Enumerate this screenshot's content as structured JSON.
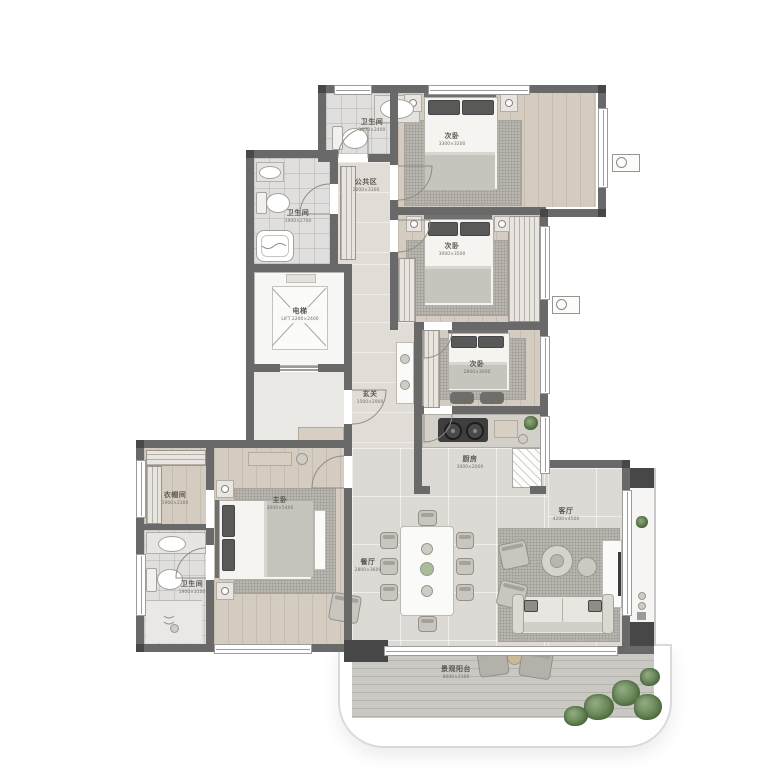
{
  "floorplan": {
    "type": "apartment-floor-plan",
    "rooms": [
      {
        "name": "卫生间",
        "dim": "1600×2400"
      },
      {
        "name": "公共区",
        "dim": "2000×3100"
      },
      {
        "name": "卫生间",
        "dim": "1900×2700"
      },
      {
        "name": "电梯",
        "dim": "LIFT 2200×2400"
      },
      {
        "name": "玄关",
        "dim": "1500×2900"
      },
      {
        "name": "次卧",
        "dim": "3300×3200"
      },
      {
        "name": "次卧",
        "dim": "3000×3500"
      },
      {
        "name": "次卧",
        "dim": "2800×3000"
      },
      {
        "name": "厨房",
        "dim": "3000×2000"
      },
      {
        "name": "衣帽间",
        "dim": "1900×2300"
      },
      {
        "name": "主卧",
        "dim": "3000×5400"
      },
      {
        "name": "卫生间",
        "dim": "1900×3100"
      },
      {
        "name": "餐厅",
        "dim": "2800×3600"
      },
      {
        "name": "客厅",
        "dim": "4200×4500"
      },
      {
        "name": "景观阳台",
        "dim": "8000×2100"
      }
    ],
    "colors": {
      "wall": "#696969",
      "wall_dark": "#474747",
      "wood_floor": "#d2c9be",
      "marble_floor": "#dddad5",
      "tile_floor": "#e0dfdd",
      "deck_floor": "#cac8c3",
      "rug": "#b8b6ae",
      "plant": "#60804f"
    }
  }
}
